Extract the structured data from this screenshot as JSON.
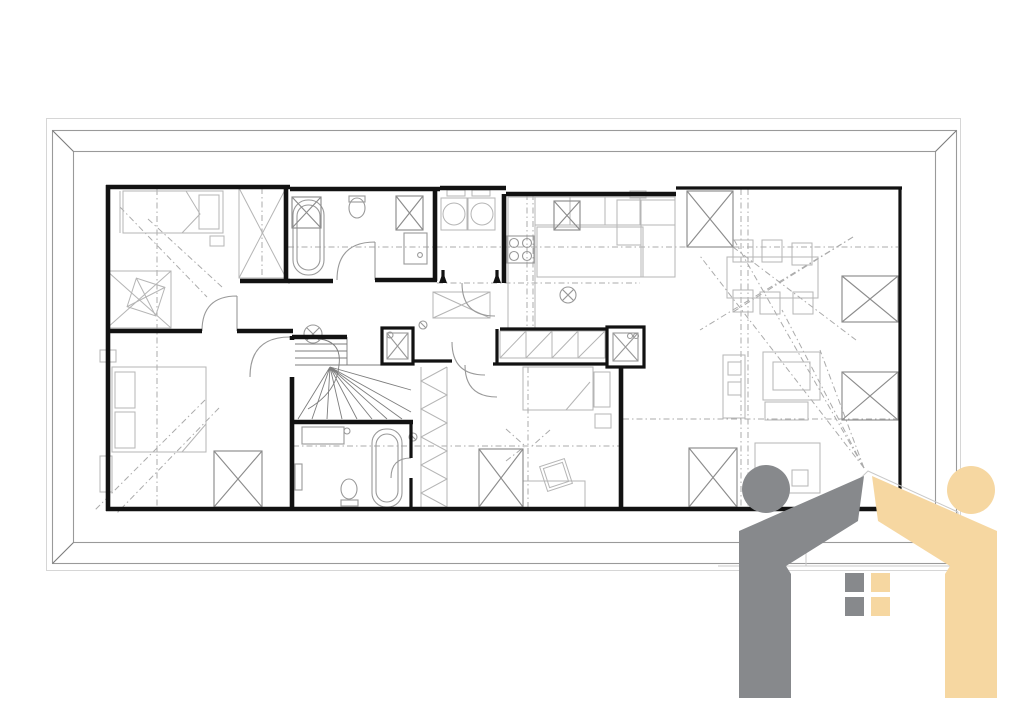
{
  "canvas": {
    "width": 1024,
    "height": 724
  },
  "colors": {
    "background": "#ffffff",
    "wall": "#121212",
    "furniture": "#b5b5b5",
    "fixture": "#999999",
    "dashed": "#ababab",
    "frame": "#9a9a9a",
    "logo_gray": "#87898c",
    "logo_yellow": "#f6d7a1"
  },
  "drawing": {
    "kind": "attic floor plan in picture frame",
    "symbols": {
      "roof_window_icon": "rectangle-with-x",
      "ceiling_lamp_icon": "circle-with-x",
      "wardrobe_icon": "zigzag-chevrons",
      "stairs_icon": "fan-treads",
      "door_icon": "quarter-arc",
      "view_cone_icon": "dashed-rays"
    },
    "roof_window_count": 9,
    "ceiling_lamp_count": 2
  },
  "logo": {
    "left_figure_color": "#87898c",
    "right_figure_color": "#f6d7a1",
    "window_panes": {
      "left_column": "#87898c",
      "right_column": "#f6d7a1"
    }
  }
}
